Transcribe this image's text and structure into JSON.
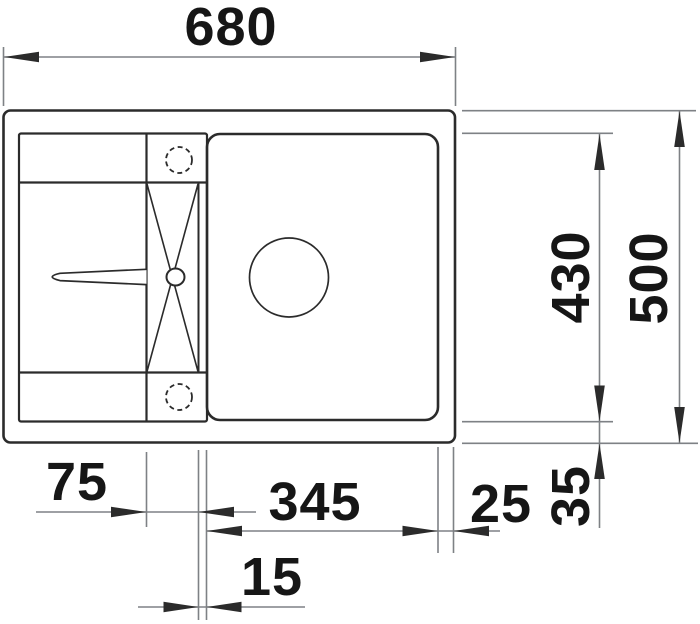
{
  "drawing": {
    "title": "Kitchen sink technical drawing, top view with dimensions",
    "units": "mm",
    "colors": {
      "outline": "#2b2b2b",
      "dim_line": "#7e8185",
      "text": "#161616",
      "background": "#ffffff"
    },
    "dims": {
      "overall_width": "680",
      "overall_depth": "500",
      "cutout_depth": "430",
      "tap_ledge_width": "75",
      "bowl_width": "345",
      "bowl_to_edge_gap": "25",
      "rim_depth": "35",
      "ledge_to_bowl_gap": "15"
    }
  }
}
